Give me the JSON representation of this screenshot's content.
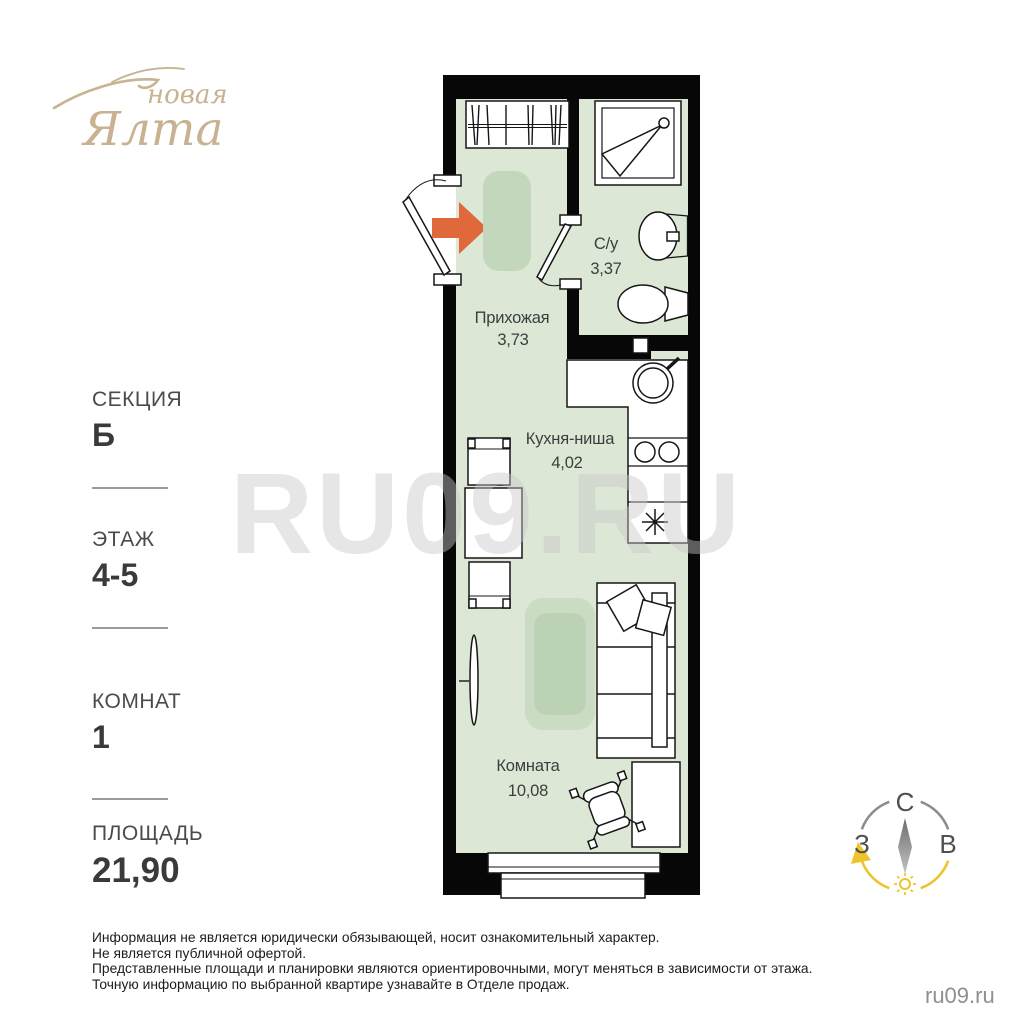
{
  "logo": {
    "brand_top": "новая",
    "brand_bottom": "Ялта"
  },
  "sidebar": {
    "section_label": "СЕКЦИЯ",
    "section_value": "Б",
    "floor_label": "ЭТАЖ",
    "floor_value": "4-5",
    "rooms_label": "КОМНАТ",
    "rooms_value": "1",
    "area_label": "ПЛОЩАДЬ",
    "area_value": "21,90"
  },
  "plan": {
    "hallway": {
      "name": "Прихожая",
      "area": "3,73"
    },
    "bathroom": {
      "name": "С/у",
      "area": "3,37"
    },
    "kitchen": {
      "name": "Кухня-ниша",
      "area": "4,02"
    },
    "room": {
      "name": "Комната",
      "area": "10,08"
    }
  },
  "watermark": "RU09.RU",
  "compass": {
    "north": "С",
    "west": "З",
    "east": "В"
  },
  "footer": {
    "disclaimer": [
      "Информация не является юридически обязывающей, носит ознакомительный характер.",
      "Не является публичной офертой.",
      "Представленные площади и планировки являются ориентировочными, могут меняться в зависимости от этажа.",
      "Точную информацию по выбранной квартире узнавайте в Отделе продаж."
    ],
    "site": "ru09.ru"
  },
  "colors": {
    "wall_black": "#070707",
    "room_fill": "#dce8d5",
    "rug_fill": "#c3d7bd",
    "accent_orange": "#e0693c",
    "logo_tan": "#c9b291",
    "compass_yellow": "#eec42c"
  }
}
